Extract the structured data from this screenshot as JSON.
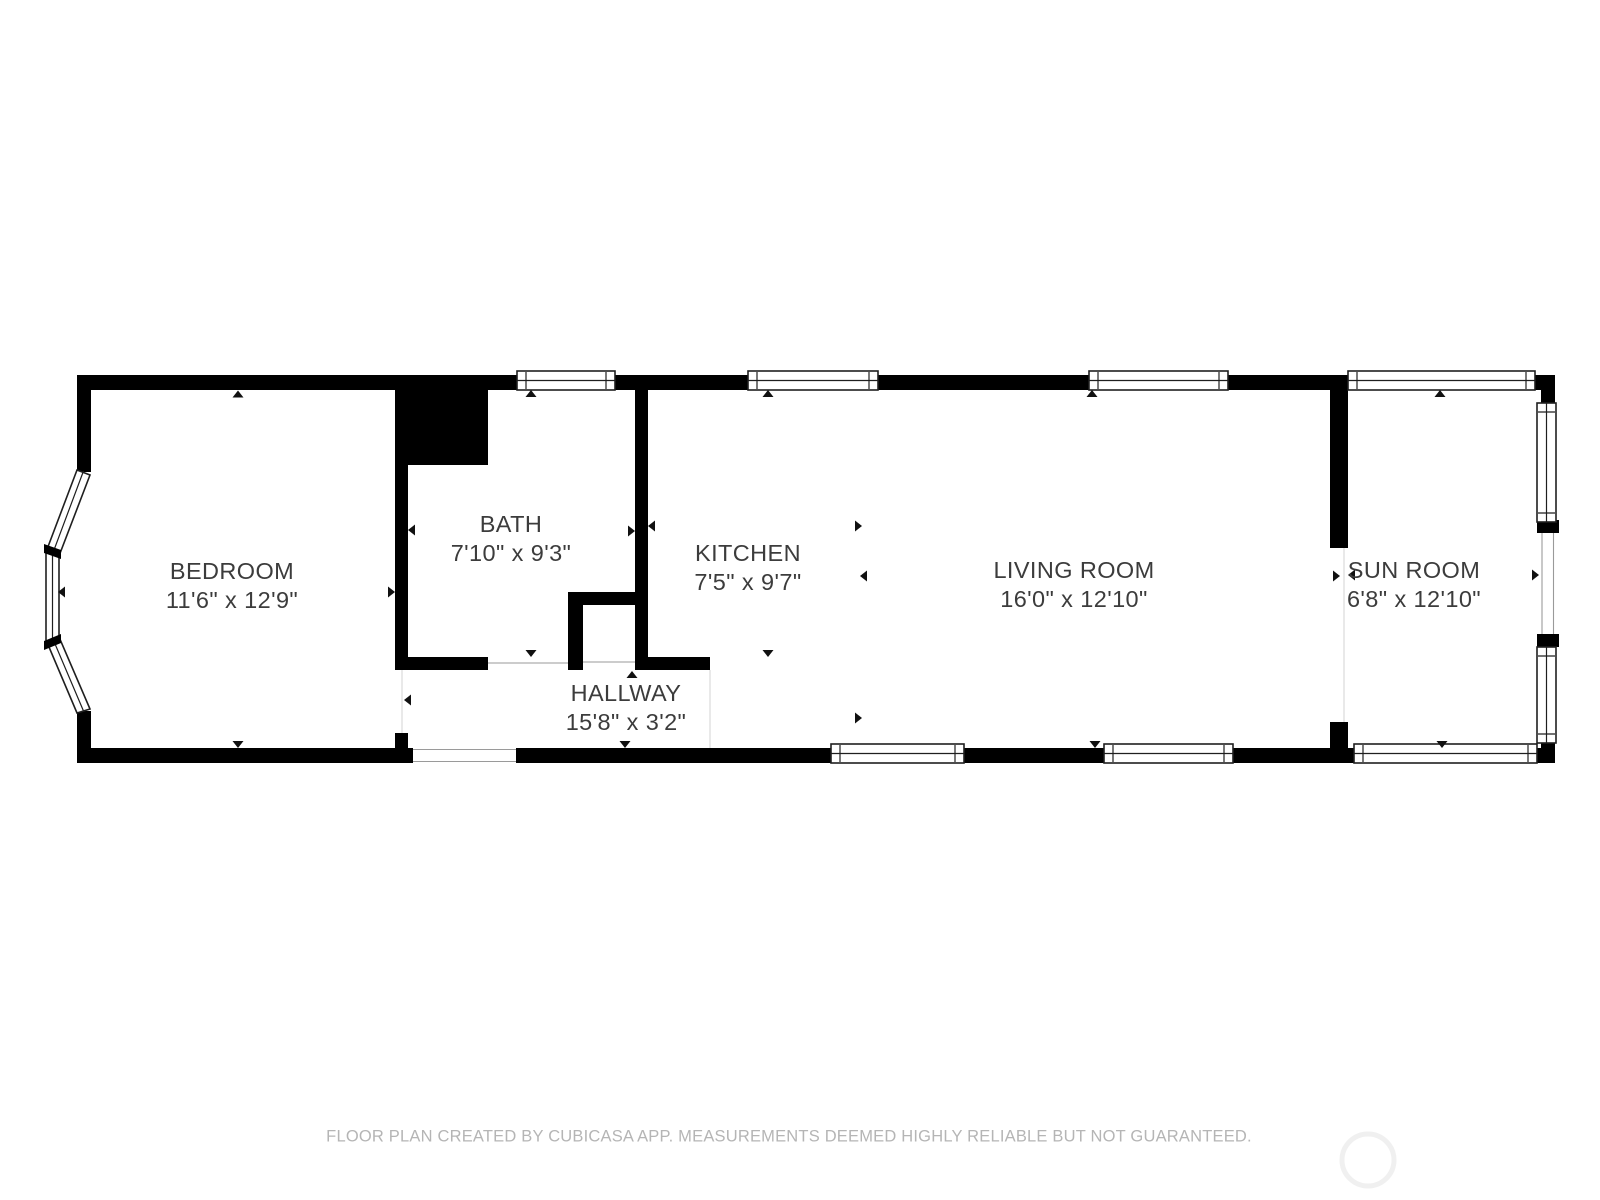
{
  "floor_plan": {
    "rooms": [
      {
        "name": "BEDROOM",
        "dimensions": "11'6\" x 12'9\""
      },
      {
        "name": "BATH",
        "dimensions": "7'10\" x 9'3\""
      },
      {
        "name": "KITCHEN",
        "dimensions": "7'5\" x 9'7\""
      },
      {
        "name": "HALLWAY",
        "dimensions": "15'8\" x 3'2\""
      },
      {
        "name": "LIVING ROOM",
        "dimensions": "16'0\" x 12'10\""
      },
      {
        "name": "SUN ROOM",
        "dimensions": "6'8\" x 12'10\""
      }
    ],
    "footer_text": "FLOOR PLAN CREATED BY CUBICASA APP. MEASUREMENTS DEEMED HIGHLY RELIABLE BUT NOT GUARANTEED.",
    "colors": {
      "wall": "#000000",
      "label_text": "#3c3c3c",
      "footer_text": "#b5b5b5",
      "background": "#ffffff",
      "watermark_ring": "#f0f0f0"
    }
  }
}
